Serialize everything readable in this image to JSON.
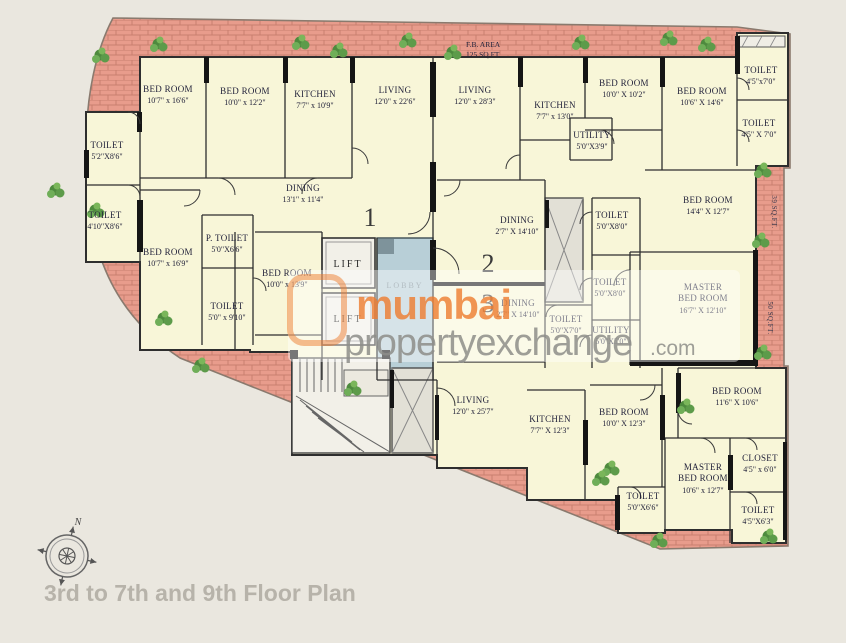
{
  "title": "3rd to 7th and 9th Floor Plan",
  "compass": {
    "north_label": "N"
  },
  "watermark": {
    "part1": "mumbai",
    "part2": "propertyexchange",
    "part3": ".com",
    "orange": "#ee7c2e",
    "gray": "#8e8e8a"
  },
  "annotations": {
    "fb_area_line1": "F.B. AREA",
    "fb_area_line2": "125 SQ.FT.",
    "strip_right_upper": "39 SQ.FT.",
    "strip_right_lower": "50 SQ.FT."
  },
  "core": {
    "lift1": "LIFT",
    "lift2": "LIFT",
    "lobby": "LOBBY"
  },
  "units": [
    {
      "number": "1"
    },
    {
      "number": "2"
    },
    {
      "number": "3"
    }
  ],
  "colors": {
    "background": "#eae7df",
    "room_fill": "#f8f6d8",
    "terrace_brick": "#e89c8c",
    "wall": "#151515",
    "lobby": "#b8cfd7",
    "plant_green": "#5d9b4a",
    "title_gray": "#b7b3aa"
  },
  "rooms": [
    {
      "name": "BED ROOM",
      "dim": "10'7\" x 16'6\""
    },
    {
      "name": "BED ROOM",
      "dim": "10'0\" x 12'2\""
    },
    {
      "name": "KITCHEN",
      "dim": "7'7\" x 10'9\""
    },
    {
      "name": "TOILET",
      "dim": "5'2\"X8'6\""
    },
    {
      "name": "TOILET",
      "dim": "4'10\"X8'6\""
    },
    {
      "name": "DINING",
      "dim": "13'1\" x 11'4\""
    },
    {
      "name": "BED ROOM",
      "dim": "10'7\" x 16'9\""
    },
    {
      "name": "P. TOILET",
      "dim": "5'0\"X6'6\""
    },
    {
      "name": "BED ROOM",
      "dim": "10'0\" x 13'9\""
    },
    {
      "name": "TOILET",
      "dim": "5'0\" x 9'10\""
    },
    {
      "name": "LIVING",
      "dim": "12'0\" x 22'6\""
    },
    {
      "name": "LIVING",
      "dim": "12'0\" x 28'3\""
    },
    {
      "name": "KITCHEN",
      "dim": "7'7\" x 13'0\""
    },
    {
      "name": "UTILITY",
      "dim": "5'0\"X3'9\""
    },
    {
      "name": "DINING",
      "dim": "2'7\" X 14'10\""
    },
    {
      "name": "TOILET",
      "dim": "5'0\"X8'0\""
    },
    {
      "name": "TOILET",
      "dim": "5'0\"X8'0\""
    },
    {
      "name": "DINING",
      "dim": "2'7\" X 14'10\""
    },
    {
      "name": "TOILET",
      "dim": "5'0\"X7'0\""
    },
    {
      "name": "UTILITY",
      "dim": "5'0\"X5'0\""
    },
    {
      "name": "LIVING",
      "dim": "12'0\" x 25'7\""
    },
    {
      "name": "KITCHEN",
      "dim": "7'7\" X 12'3\""
    },
    {
      "name": "BED ROOM",
      "dim": "10'0\" X 12'3\""
    },
    {
      "name": "TOILET",
      "dim": "5'0\"X6'6\""
    },
    {
      "name": "BED ROOM",
      "dim": "10'0\" X 10'2\""
    },
    {
      "name": "BED ROOM",
      "dim": "10'6\" X 14'6\""
    },
    {
      "name": "TOILET",
      "dim": "4'5\"x7'0\""
    },
    {
      "name": "TOILET",
      "dim": "4'5\" X 7'0\""
    },
    {
      "name": "BED ROOM",
      "dim": "14'4\" X 12'7\""
    },
    {
      "name": "MASTER",
      "name2": "BED ROOM",
      "dim": "16'7\" X 12'10\""
    },
    {
      "name": "BED ROOM",
      "dim": "11'6\" X 10'6\""
    },
    {
      "name": "CLOSET",
      "dim": "4'5\" x 6'0\""
    },
    {
      "name": "MASTER",
      "name2": "BED ROOM",
      "dim": "10'6\" x 12'7\""
    },
    {
      "name": "TOILET",
      "dim": "4'5\"X6'3\""
    }
  ]
}
